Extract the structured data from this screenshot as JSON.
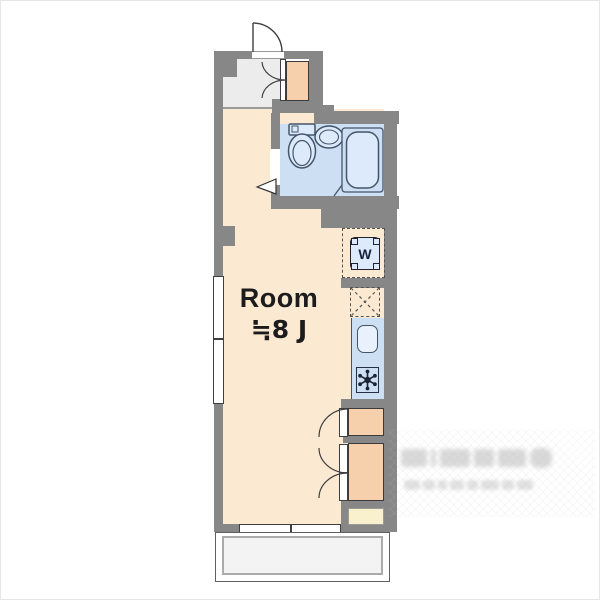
{
  "floorplan": {
    "room_label": {
      "name": "Room",
      "size": "≒8 J"
    },
    "washer_label": "W",
    "watermark": {
      "present": true,
      "legible": false
    },
    "colors": {
      "wall": "#878787",
      "room_floor": "#fce9d2",
      "entry_floor": "#ececec",
      "wet_floor": "#cde0f3",
      "fixture_fill": "#dceafb",
      "fixture_outline": "#44546a",
      "closet_fill": "#f6cfad",
      "closet_outline": "#3a3a3a",
      "counter_fill": "#f9f1cd",
      "balcony_floor": "#f3f3f3",
      "label_text": "#1c1c1c",
      "line": "#3f3f3f"
    }
  }
}
